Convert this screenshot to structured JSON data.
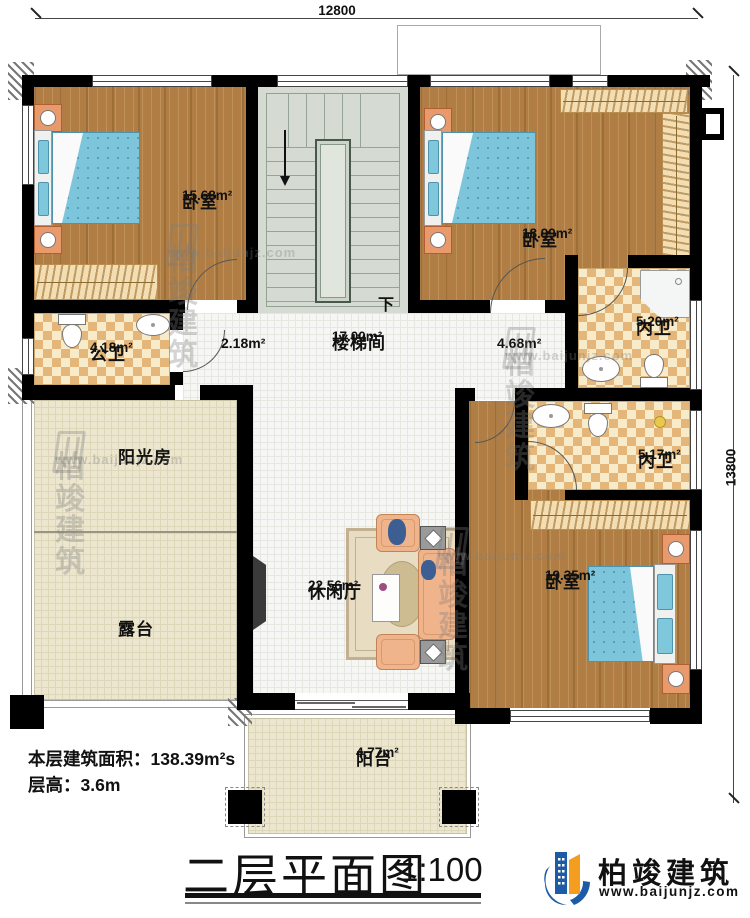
{
  "dimensions": {
    "width_mm": "12800",
    "height_mm": "13800"
  },
  "rooms": {
    "bedroom1": {
      "label": "卧室",
      "area": "15.68m²"
    },
    "bedroom2": {
      "label": "卧室",
      "area": "18.99m²"
    },
    "ensuite_bath1": {
      "label": "内卫",
      "area": "5.20m²"
    },
    "public_bath": {
      "label": "公卫",
      "area": "4.18m²"
    },
    "corridor": {
      "area": "2.18m²"
    },
    "stairwell": {
      "label": "楼梯间",
      "area": "17.00m²"
    },
    "hallway": {
      "area": "4.68m²"
    },
    "ensuite_bath2": {
      "label": "内卫",
      "area": "5.17m²"
    },
    "sunroom": {
      "label": "阳光房"
    },
    "terrace": {
      "label": "露台"
    },
    "lounge": {
      "label": "休闲厅",
      "area": "22.56m²"
    },
    "bedroom3": {
      "label": "卧室",
      "area": "19.35m²"
    },
    "balcony": {
      "label": "阳台",
      "area": "4.77m²"
    }
  },
  "stairs": {
    "direction_label": "下"
  },
  "info": {
    "floor_area": "本层建筑面积：138.39m²s",
    "floor_height": "层高：3.6m"
  },
  "title": {
    "text": "二层平面图",
    "scale": "1:100"
  },
  "brand": {
    "name": "柏竣建筑",
    "website": "www.baijunjz.com"
  },
  "watermark": {
    "name": "柏竣建筑",
    "website": "www.baijunjz.com"
  },
  "colors": {
    "wall": "#000000",
    "wood_floor": "#b07e44",
    "tile_light": "#f7ebc9",
    "tile_dark": "#e5b679",
    "bed_blue": "#7cc5da",
    "floor_beige": "#ece6cf",
    "stair_gray": "#d5dbd2",
    "logo_blue": "#1c5ca6",
    "logo_orange": "#f59d1f"
  }
}
